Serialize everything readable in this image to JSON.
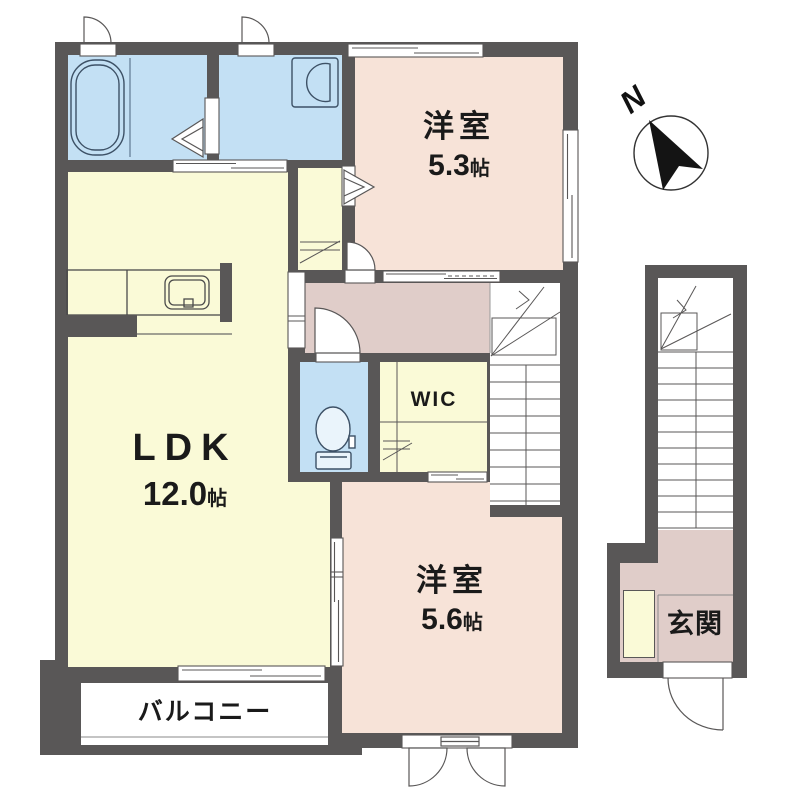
{
  "compass": {
    "label": "N"
  },
  "rooms": {
    "ldk": {
      "name": "LDK",
      "size_value": "12.0",
      "size_unit": "帖"
    },
    "bedroom_53": {
      "name": "洋室",
      "size_value": "5.3",
      "size_unit": "帖"
    },
    "bedroom_56": {
      "name": "洋室",
      "size_value": "5.6",
      "size_unit": "帖"
    },
    "wic": {
      "name": "WIC"
    },
    "balcony": {
      "name": "バルコニー"
    },
    "entrance": {
      "name": "玄関"
    }
  },
  "icons": {
    "compass": "north-arrow-icon",
    "fixtures": [
      "bathtub-icon",
      "washbasin-icon",
      "toilet-icon",
      "kitchen-sink-icon"
    ]
  },
  "colors": {
    "wall": "#595757",
    "room_yellow": "#fafad7",
    "room_pink": "#f7e3d8",
    "hall_pink": "#e0cdc9",
    "water_blue": "#c3e0f4",
    "background": "#ffffff",
    "line": "#4a4a4a",
    "text": "#1a1a1a"
  }
}
